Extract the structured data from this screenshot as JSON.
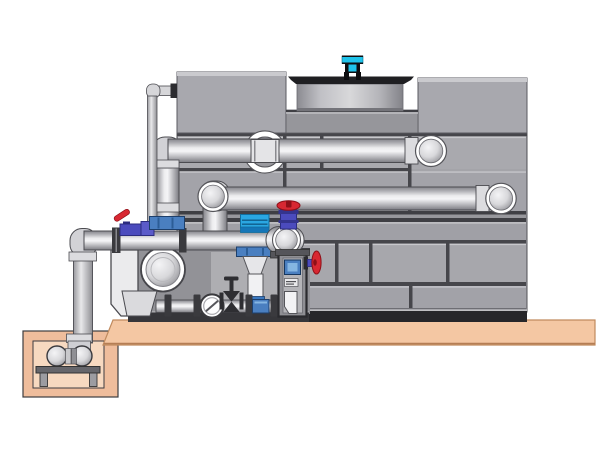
{
  "meta": {
    "description": "Technical illustration of a cooling tower unit: paneled gray tower casing with rooftop fan shroud and cyan fan motor, two horizontal supply/return pipes entering the casing, a front pump skid with strainer, inline pump funnel, sight glass, gate valve, red handwheel valves and a control column, all mounted on a tan concrete pad with a sump pit and small transfer pump at lower left.",
    "width": 600,
    "height": 450
  },
  "colors": {
    "accent": "#1fc3ea",
    "accent-dark": "#0e0e10",
    "red": "#d82832",
    "red-dark": "#8e1018",
    "indigo": "#4b4bbd",
    "indigo-dark": "#2c2c80",
    "steel": "#4a7fc0",
    "steel-dark": "#1d3f6b",
    "strainer": "#2aa7e2",
    "strainer-band": "#1576b8",
    "slab": "#f4c7a3",
    "slab-edge": "#c08a5e",
    "pit-wall": "#efbd9c",
    "pit-cavity": "#f7d9c0",
    "tank": "#a4a4a9",
    "seam": "#46464b",
    "base-bar": "#26262a",
    "plate-dark": "#1f1f22"
  },
  "components": {
    "tower": {
      "name": "cooling-tower-casing",
      "top_boxes": [
        "left-plenum-box",
        "right-plenum-box"
      ],
      "fan": {
        "shroud": "fan-shroud-cylinder",
        "deck": "fan-deck-plate",
        "motor": "fan-motor"
      }
    },
    "piping": {
      "supply_pipe": "upper horizontal pipe with wall penetration ring and end elbow",
      "return_pipe": "second horizontal pipe with front-facing elbows both ends",
      "makeup_line": "thin vertical line from tower top-left down to manifold valve",
      "suction_manifold": "large horizontal pipe across pump skid",
      "sump_riser": "vertical pipe from sump pit to manifold elbow"
    },
    "skid": {
      "strainer": "cyan strainer cap",
      "inline_pump": "funnel-shaped vertical unit",
      "sight_glass": "circular flow indicator",
      "gate_valve": "dark bowtie gate valve",
      "valves_red": [
        "handwheel valve on discharge riser",
        "side handwheel valve on control column",
        "lever ball valve on manifold"
      ],
      "control_column": "instrument column with gauge and drain elbow"
    },
    "foundation": {
      "pad": "concrete-pad",
      "pit": "sump-pit",
      "pump": "sump-transfer-pump"
    }
  }
}
